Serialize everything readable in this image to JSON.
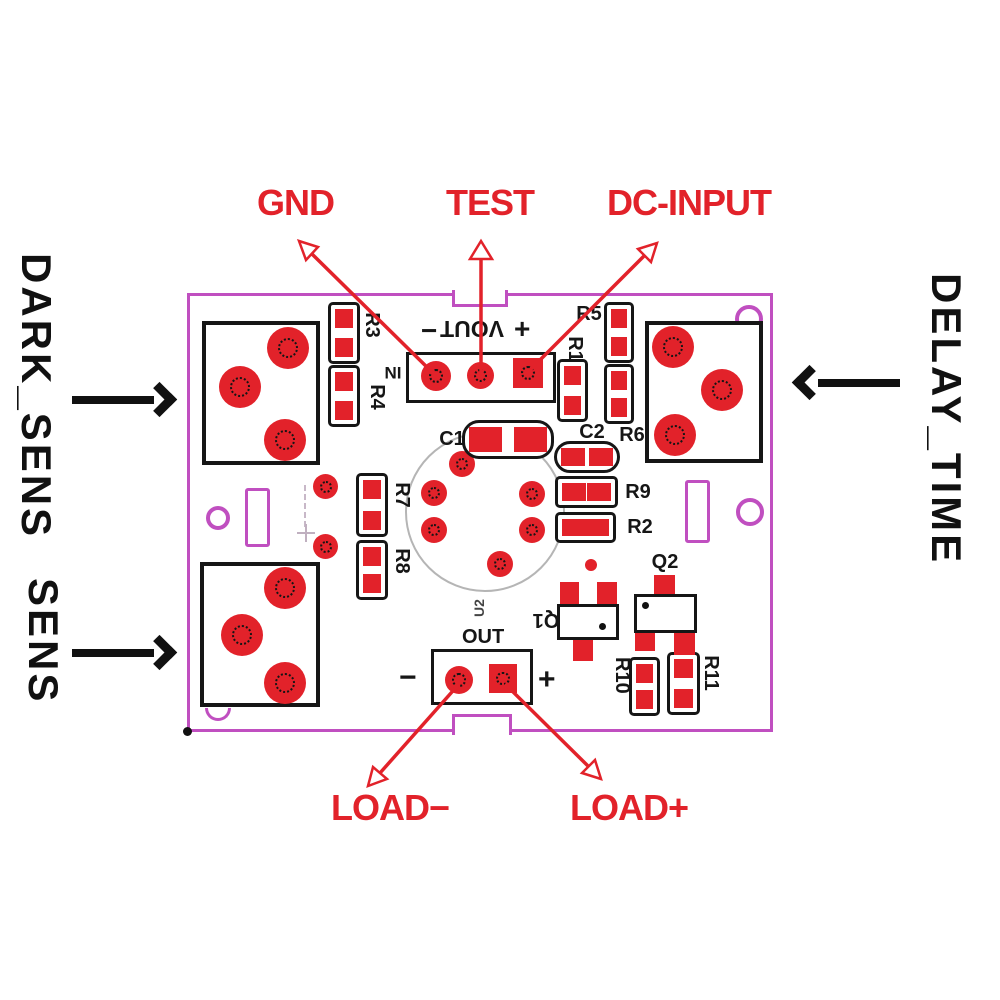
{
  "colors": {
    "red": "#e2222a",
    "purple": "#c04fc0",
    "ink": "#161616",
    "gray": "#b5b5b5"
  },
  "pin_labels": {
    "gnd": "GND",
    "test": "TEST",
    "dc_input": "DC-INPUT",
    "load_minus": "LOAD−",
    "load_plus": "LOAD+"
  },
  "adjust_labels": {
    "dark_sens": "DARK_SENS",
    "sens": "SENS",
    "delay_time": "DELAY_TIME"
  },
  "connector_vout": {
    "name": "VOUT",
    "in_ref": "IN",
    "minus": "−",
    "plus": "+"
  },
  "connector_out": {
    "name": "OUT",
    "ref": "U2",
    "minus": "−",
    "plus": "+"
  },
  "components": {
    "r1": "R1",
    "r2": "R2",
    "r3": "R3",
    "r4": "R4",
    "r5": "R5",
    "r6": "R6",
    "r7": "R7",
    "r8": "R8",
    "r9": "R9",
    "r10": "R10",
    "r11": "R11",
    "c1": "C1",
    "c2": "C2",
    "q1": "Q1",
    "q2": "Q2"
  }
}
